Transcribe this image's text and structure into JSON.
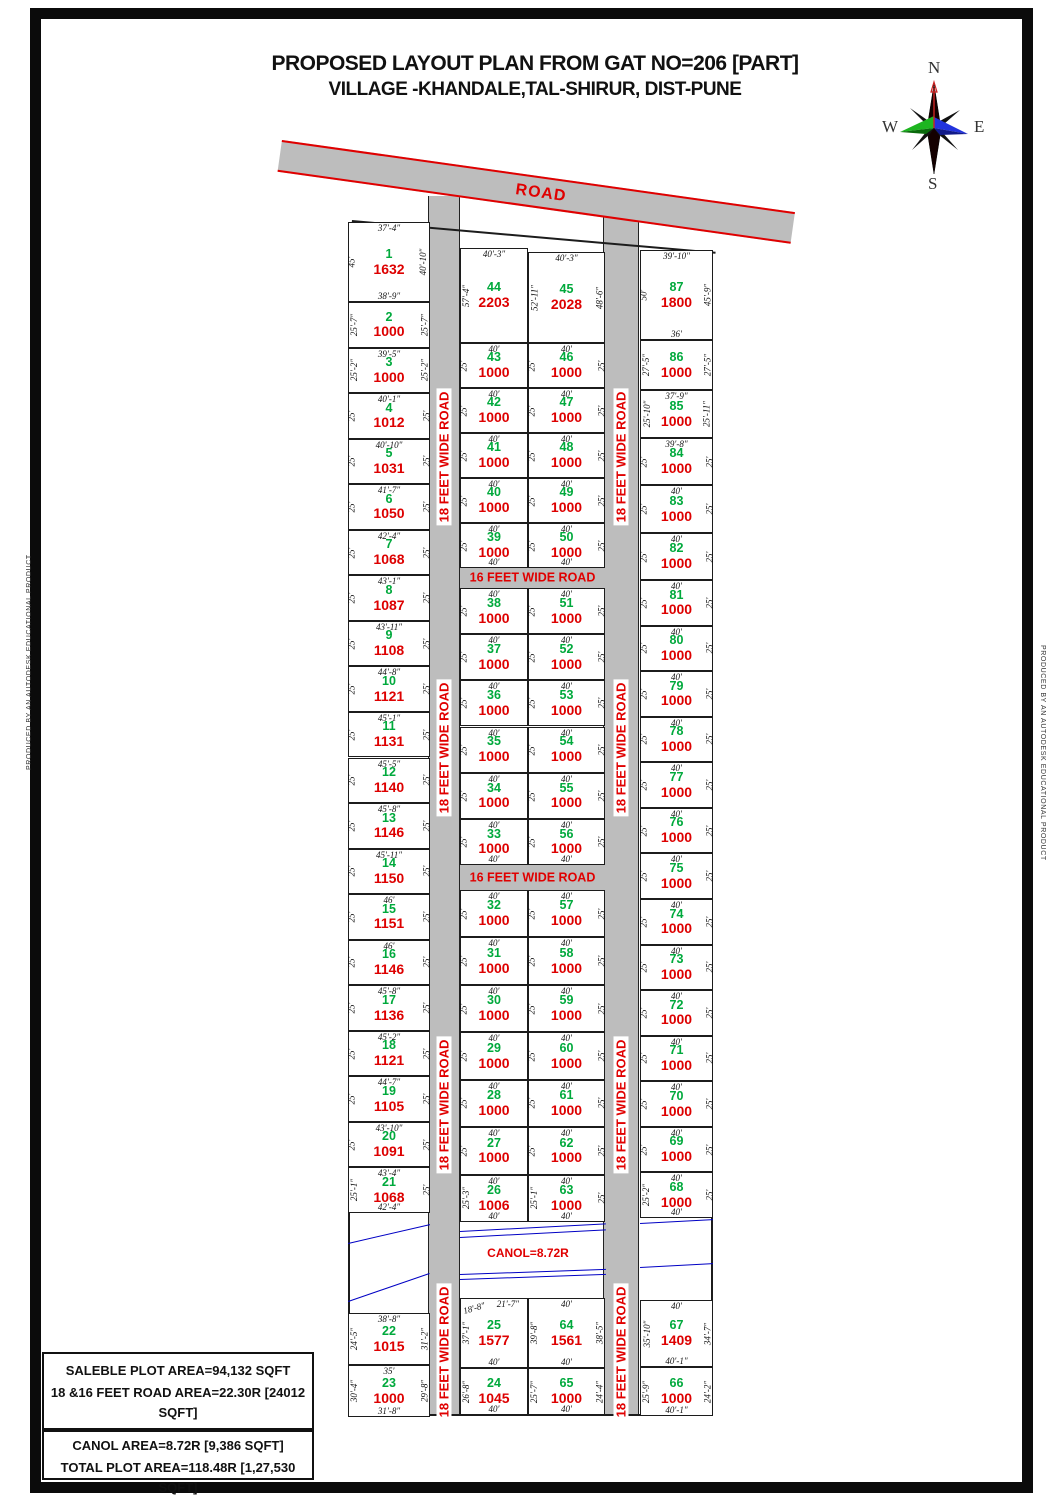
{
  "title": {
    "line1": "PROPOSED LAYOUT PLAN FROM GAT NO=206 [PART]",
    "line2": "VILLAGE -KHANDALE,TAL-SHIRUR, DIST-PUNE"
  },
  "compass": {
    "north": "N",
    "south": "S",
    "east": "E",
    "west": "W"
  },
  "roads": {
    "top": "ROAD",
    "vertical": "18 FEET WIDE ROAD",
    "horizontal": "16 FEET WIDE ROAD"
  },
  "canal": {
    "label": "CANOL=8.72R"
  },
  "producer": "PRODUCED BY AN AUTODESK EDUCATIONAL PRODUCT",
  "summary": {
    "box1": [
      "SALEBLE PLOT AREA=94,132  SQFT",
      "18 &16 FEET ROAD AREA=22.30R [24012 SQFT]",
      "PLOTING AREA=109.76R [1,18,144 SQFT]"
    ],
    "box2": [
      "CANOL AREA=8.72R [9,386 SQFT]",
      "TOTAL PLOT AREA=118.48R [1,27,530 SQFT]"
    ]
  },
  "colors": {
    "plot_number": "#00a93c",
    "plot_area": "#dd0000",
    "road_fill": "#bdbdbd",
    "road_text": "#e00000",
    "canal_line": "#0000c4",
    "dim_text": "#111111"
  },
  "plots": [
    {
      "n": 1,
      "col": "L",
      "area": 1632,
      "top": "37'-4\"",
      "left": "45'",
      "right": "40'-10\"",
      "bottom": "38'-9\""
    },
    {
      "n": 2,
      "col": "L",
      "area": 1000,
      "left": "25'-7\"",
      "right": "25'-7\""
    },
    {
      "n": 3,
      "col": "L",
      "area": 1000,
      "top": "39'-5\"",
      "left": "25'-2\"",
      "right": "25'-2\""
    },
    {
      "n": 4,
      "col": "L",
      "area": 1012,
      "top": "40'-1\"",
      "left": "25'",
      "right": "25'"
    },
    {
      "n": 5,
      "col": "L",
      "area": 1031,
      "top": "40'-10\"",
      "left": "25'",
      "right": "25'"
    },
    {
      "n": 6,
      "col": "L",
      "area": 1050,
      "top": "41'-7\"",
      "left": "25'",
      "right": "25'"
    },
    {
      "n": 7,
      "col": "L",
      "area": 1068,
      "top": "42'-4\"",
      "left": "25'",
      "right": "25'"
    },
    {
      "n": 8,
      "col": "L",
      "area": 1087,
      "top": "43'-1\"",
      "left": "25'",
      "right": "25'"
    },
    {
      "n": 9,
      "col": "L",
      "area": 1108,
      "top": "43'-11\"",
      "left": "25'",
      "right": "25'"
    },
    {
      "n": 10,
      "col": "L",
      "area": 1121,
      "top": "44'-8\"",
      "left": "25'",
      "right": "25'"
    },
    {
      "n": 11,
      "col": "L",
      "area": 1131,
      "top": "45'-1\"",
      "left": "25'",
      "right": "25'"
    },
    {
      "n": 12,
      "col": "L",
      "area": 1140,
      "top": "45'-5\"",
      "left": "25'",
      "right": "25'"
    },
    {
      "n": 13,
      "col": "L",
      "area": 1146,
      "top": "45'-8\"",
      "left": "25'",
      "right": "25'"
    },
    {
      "n": 14,
      "col": "L",
      "area": 1150,
      "top": "45'-11\"",
      "left": "25'",
      "right": "25'"
    },
    {
      "n": 15,
      "col": "L",
      "area": 1151,
      "top": "46'",
      "left": "25'",
      "right": "25'"
    },
    {
      "n": 16,
      "col": "L",
      "area": 1146,
      "top": "46'",
      "left": "25'",
      "right": "25'"
    },
    {
      "n": 17,
      "col": "L",
      "area": 1136,
      "top": "45'-8\"",
      "left": "25'",
      "right": "25'"
    },
    {
      "n": 18,
      "col": "L",
      "area": 1121,
      "top": "45'-2\"",
      "left": "25'",
      "right": "25'"
    },
    {
      "n": 19,
      "col": "L",
      "area": 1105,
      "top": "44'-7\"",
      "left": "25'",
      "right": "25'"
    },
    {
      "n": 20,
      "col": "L",
      "area": 1091,
      "top": "43'-10\"",
      "left": "25'",
      "right": "25'"
    },
    {
      "n": 21,
      "col": "L",
      "area": 1068,
      "top": "43'-4\"",
      "left": "25'-1\"",
      "right": "25'",
      "bottom": "42'-4\""
    },
    {
      "n": 22,
      "col": "L",
      "area": 1015,
      "top": "38'-8\"",
      "left": "24'-5\"",
      "right": "31'-2\""
    },
    {
      "n": 23,
      "col": "L",
      "area": 1000,
      "top": "35'",
      "left": "30'-4\"",
      "right": "29'-8\"",
      "bottom": "31'-8\""
    },
    {
      "n": 44,
      "col": "MA",
      "area": 2203,
      "top": "40'-3\"",
      "left": "57'-4\""
    },
    {
      "n": 43,
      "col": "MA",
      "area": 1000,
      "top": "40'",
      "left": "25'"
    },
    {
      "n": 42,
      "col": "MA",
      "area": 1000,
      "top": "40'",
      "left": "25'"
    },
    {
      "n": 41,
      "col": "MA",
      "area": 1000,
      "top": "40'",
      "left": "25'"
    },
    {
      "n": 40,
      "col": "MA",
      "area": 1000,
      "top": "40'",
      "left": "25'"
    },
    {
      "n": 39,
      "col": "MA",
      "area": 1000,
      "top": "40'",
      "left": "25'",
      "bottom": "40'"
    },
    {
      "n": 38,
      "col": "MA",
      "area": 1000,
      "top": "40'",
      "left": "25'"
    },
    {
      "n": 37,
      "col": "MA",
      "area": 1000,
      "top": "40'",
      "left": "25'"
    },
    {
      "n": 36,
      "col": "MA",
      "area": 1000,
      "top": "40'",
      "left": "25'"
    },
    {
      "n": 35,
      "col": "MA",
      "area": 1000,
      "top": "40'",
      "left": "25'"
    },
    {
      "n": 34,
      "col": "MA",
      "area": 1000,
      "top": "40'",
      "left": "25'"
    },
    {
      "n": 33,
      "col": "MA",
      "area": 1000,
      "top": "40'",
      "left": "25'",
      "bottom": "40'"
    },
    {
      "n": 32,
      "col": "MA",
      "area": 1000,
      "top": "40'",
      "left": "25'"
    },
    {
      "n": 31,
      "col": "MA",
      "area": 1000,
      "top": "40'",
      "left": "25'"
    },
    {
      "n": 30,
      "col": "MA",
      "area": 1000,
      "top": "40'",
      "left": "25'"
    },
    {
      "n": 29,
      "col": "MA",
      "area": 1000,
      "top": "40'",
      "left": "25'"
    },
    {
      "n": 28,
      "col": "MA",
      "area": 1000,
      "top": "40'",
      "left": "25'"
    },
    {
      "n": 27,
      "col": "MA",
      "area": 1000,
      "top": "40'",
      "left": "25'"
    },
    {
      "n": 26,
      "col": "MA",
      "area": 1006,
      "top": "40'",
      "left": "25'-3\"",
      "bottom": "40'"
    },
    {
      "n": 25,
      "col": "MA",
      "area": 1577,
      "top": "21'-7\"",
      "top2": "18'-8\"",
      "left": "37'-1\"",
      "bottom": "40'"
    },
    {
      "n": 24,
      "col": "MA",
      "area": 1045,
      "left": "26'-8\"",
      "bottom": "40'"
    },
    {
      "n": 45,
      "col": "MB",
      "area": 2028,
      "top": "40'-3\"",
      "left": "52'-11\"",
      "right": "48'-6\""
    },
    {
      "n": 46,
      "col": "MB",
      "area": 1000,
      "top": "40'",
      "left": "25'",
      "right": "25'"
    },
    {
      "n": 47,
      "col": "MB",
      "area": 1000,
      "top": "40'",
      "left": "25'",
      "right": "25'"
    },
    {
      "n": 48,
      "col": "MB",
      "area": 1000,
      "top": "40'",
      "left": "25'",
      "right": "25'"
    },
    {
      "n": 49,
      "col": "MB",
      "area": 1000,
      "top": "40'",
      "left": "25'",
      "right": "25'"
    },
    {
      "n": 50,
      "col": "MB",
      "area": 1000,
      "top": "40'",
      "left": "25'",
      "right": "25'",
      "bottom": "40'"
    },
    {
      "n": 51,
      "col": "MB",
      "area": 1000,
      "top": "40'",
      "left": "25'",
      "right": "25'"
    },
    {
      "n": 52,
      "col": "MB",
      "area": 1000,
      "top": "40'",
      "left": "25'",
      "right": "25'"
    },
    {
      "n": 53,
      "col": "MB",
      "area": 1000,
      "top": "40'",
      "left": "25'",
      "right": "25'"
    },
    {
      "n": 54,
      "col": "MB",
      "area": 1000,
      "top": "40'",
      "left": "25'",
      "right": "25'"
    },
    {
      "n": 55,
      "col": "MB",
      "area": 1000,
      "top": "40'",
      "left": "25'",
      "right": "25'"
    },
    {
      "n": 56,
      "col": "MB",
      "area": 1000,
      "top": "40'",
      "left": "25'",
      "right": "25'",
      "bottom": "40'"
    },
    {
      "n": 57,
      "col": "MB",
      "area": 1000,
      "top": "40'",
      "left": "25'",
      "right": "25'"
    },
    {
      "n": 58,
      "col": "MB",
      "area": 1000,
      "top": "40'",
      "left": "25'",
      "right": "25'"
    },
    {
      "n": 59,
      "col": "MB",
      "area": 1000,
      "top": "40'",
      "left": "25'",
      "right": "25'"
    },
    {
      "n": 60,
      "col": "MB",
      "area": 1000,
      "top": "40'",
      "left": "25'",
      "right": "25'"
    },
    {
      "n": 61,
      "col": "MB",
      "area": 1000,
      "top": "40'",
      "left": "25'",
      "right": "25'"
    },
    {
      "n": 62,
      "col": "MB",
      "area": 1000,
      "top": "40'",
      "left": "25'",
      "right": "25'"
    },
    {
      "n": 63,
      "col": "MB",
      "area": 1000,
      "top": "40'",
      "left": "25'-1\"",
      "right": "25'",
      "bottom": "40'"
    },
    {
      "n": 64,
      "col": "MB",
      "area": 1561,
      "top": "40'",
      "left": "39'-8\"",
      "right": "38'-5\"",
      "bottom": "40'"
    },
    {
      "n": 65,
      "col": "MB",
      "area": 1000,
      "left": "25'-7\"",
      "right": "24'-4\"",
      "bottom": "40'"
    },
    {
      "n": 87,
      "col": "R",
      "area": 1800,
      "top": "39'-10\"",
      "left": "50'",
      "right": "45'-9\"",
      "bottom": "36'"
    },
    {
      "n": 86,
      "col": "R",
      "area": 1000,
      "left": "27'-5\"",
      "right": "27'-5\""
    },
    {
      "n": 85,
      "col": "R",
      "area": 1000,
      "top": "37'-9\"",
      "left": "25'-10\"",
      "right": "25'-11\""
    },
    {
      "n": 84,
      "col": "R",
      "area": 1000,
      "top": "39'-8\"",
      "left": "25'",
      "right": "25'"
    },
    {
      "n": 83,
      "col": "R",
      "area": 1000,
      "top": "40'",
      "left": "25'",
      "right": "25'"
    },
    {
      "n": 82,
      "col": "R",
      "area": 1000,
      "top": "40'",
      "left": "25'",
      "right": "25'"
    },
    {
      "n": 81,
      "col": "R",
      "area": 1000,
      "top": "40'",
      "left": "25'",
      "right": "25'"
    },
    {
      "n": 80,
      "col": "R",
      "area": 1000,
      "top": "40'",
      "left": "25'",
      "right": "25'"
    },
    {
      "n": 79,
      "col": "R",
      "area": 1000,
      "top": "40'",
      "left": "25'",
      "right": "25'"
    },
    {
      "n": 78,
      "col": "R",
      "area": 1000,
      "top": "40'",
      "left": "25'",
      "right": "25'"
    },
    {
      "n": 77,
      "col": "R",
      "area": 1000,
      "top": "40'",
      "left": "25'",
      "right": "25'"
    },
    {
      "n": 76,
      "col": "R",
      "area": 1000,
      "top": "40'",
      "left": "25'",
      "right": "25'"
    },
    {
      "n": 75,
      "col": "R",
      "area": 1000,
      "top": "40'",
      "left": "25'",
      "right": "25'"
    },
    {
      "n": 74,
      "col": "R",
      "area": 1000,
      "top": "40'",
      "left": "25'",
      "right": "25'"
    },
    {
      "n": 73,
      "col": "R",
      "area": 1000,
      "top": "40'",
      "left": "25'",
      "right": "25'"
    },
    {
      "n": 72,
      "col": "R",
      "area": 1000,
      "top": "40'",
      "left": "25'",
      "right": "25'"
    },
    {
      "n": 71,
      "col": "R",
      "area": 1000,
      "top": "40'",
      "left": "25'",
      "right": "25'"
    },
    {
      "n": 70,
      "col": "R",
      "area": 1000,
      "top": "40'",
      "left": "25'",
      "right": "25'"
    },
    {
      "n": 69,
      "col": "R",
      "area": 1000,
      "top": "40'",
      "left": "25'",
      "right": "25'"
    },
    {
      "n": 68,
      "col": "R",
      "area": 1000,
      "top": "40'",
      "left": "25'-2\"",
      "right": "25'",
      "bottom": "40'"
    },
    {
      "n": 67,
      "col": "R",
      "area": 1409,
      "top": "40'",
      "left": "35'-10\"",
      "right": "34'-7\"",
      "bottom": "40'-1\""
    },
    {
      "n": 66,
      "col": "R",
      "area": 1000,
      "left": "25'-9\"",
      "right": "24'-2\"",
      "bottom": "40'-1\""
    }
  ]
}
